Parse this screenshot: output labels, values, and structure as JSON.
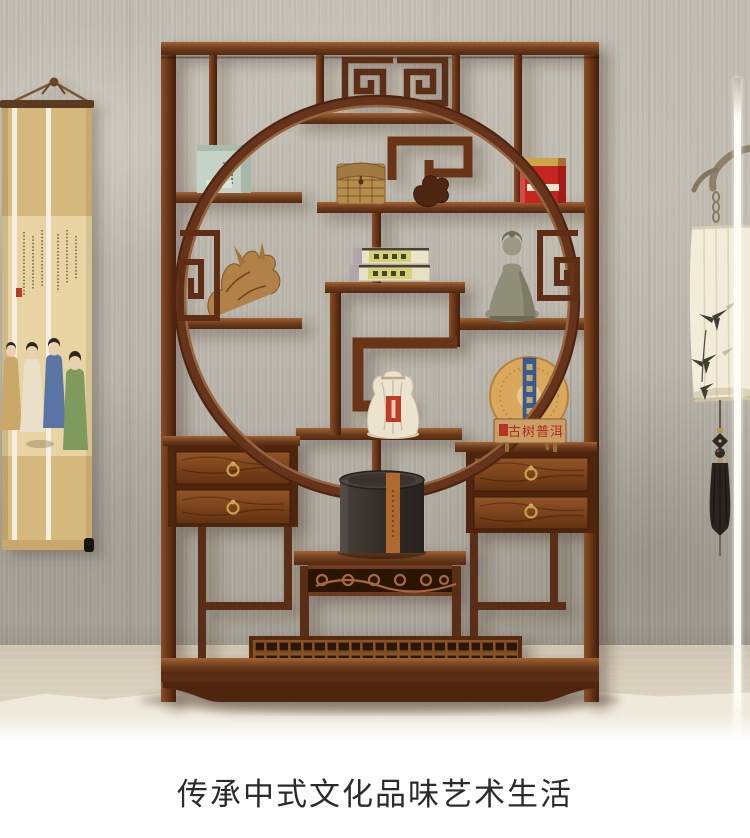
{
  "caption": {
    "text": "传承中式文化品味艺术生活"
  },
  "shelf": {
    "plaque_text": "古树普洱"
  },
  "colors": {
    "wood_dark": "#53290f",
    "wood_mid": "#6e3a1c",
    "wood_light": "#a06334",
    "wall": "#bab6ac",
    "floor": "#d5ccba",
    "carpet": "#efe9dc",
    "red_tin": "#c52520",
    "green_tin": "#c5d3c6",
    "sack_label_red": "#c03a26",
    "tea_cake_band_blue": "#3a5a94",
    "plaque_text_red": "#b3281c"
  }
}
